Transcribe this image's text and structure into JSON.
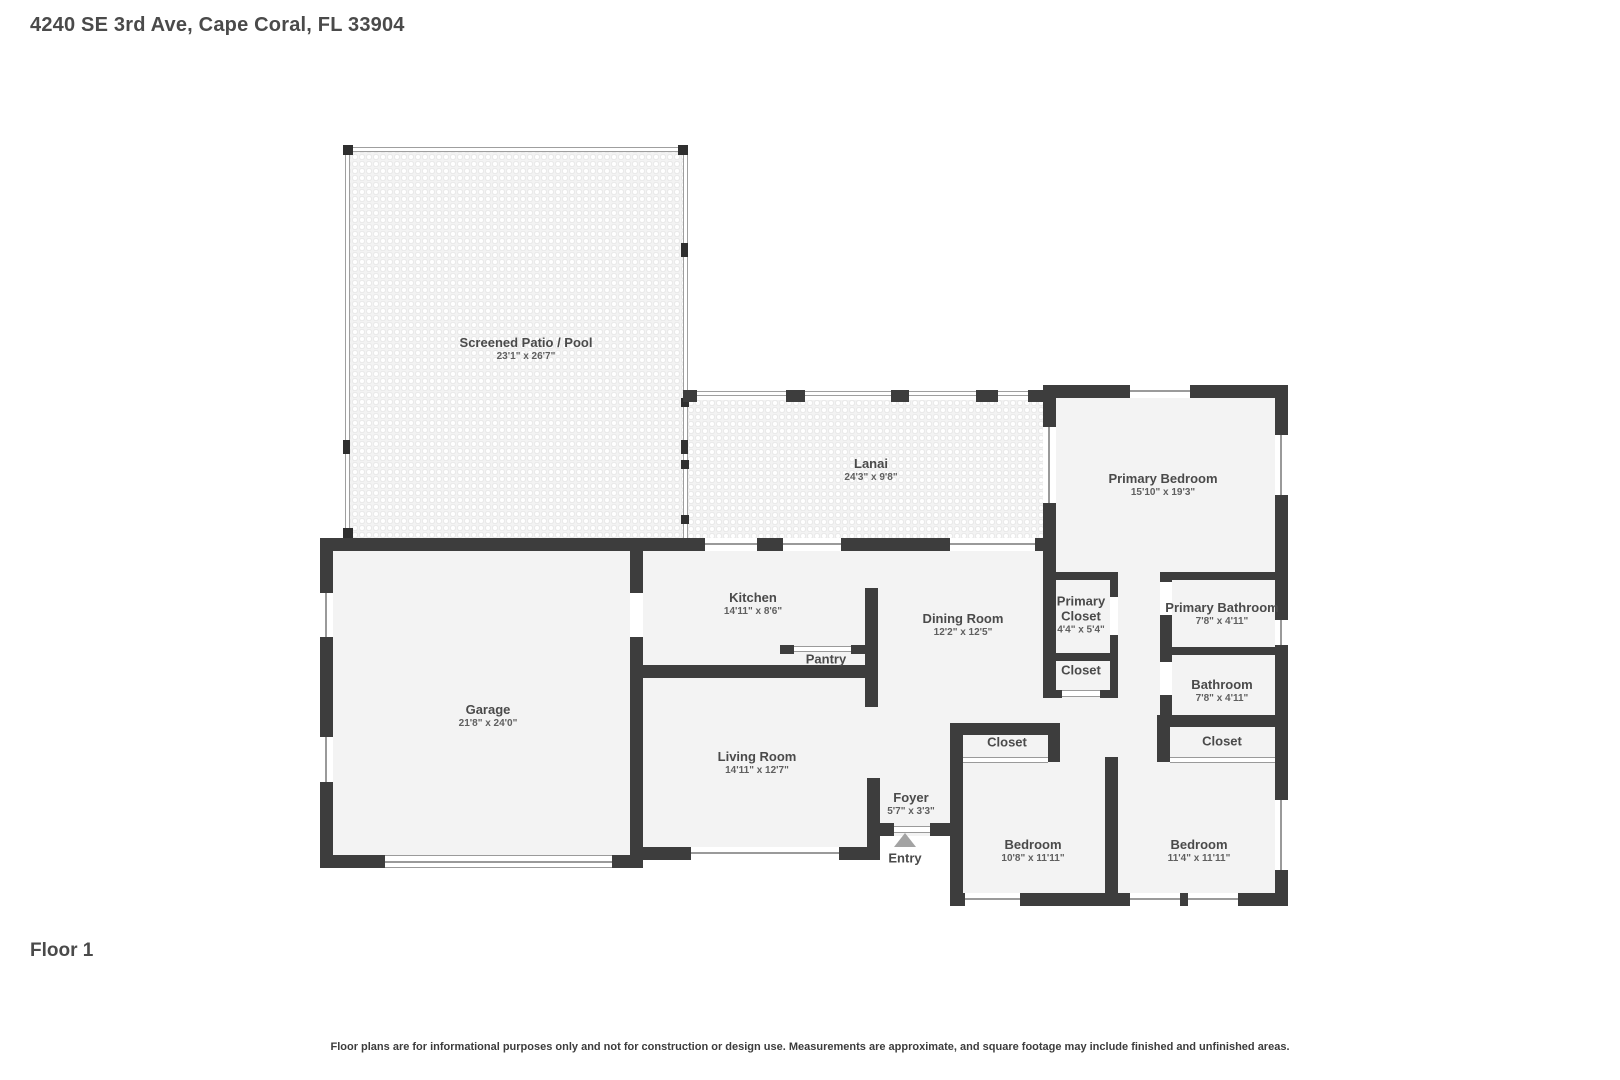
{
  "title": "4240 SE 3rd Ave, Cape Coral, FL 33904",
  "floor_label": "Floor 1",
  "disclaimer": "Floor plans are for informational purposes only and not for construction or design use. Measurements are approximate, and square footage may include finished and unfinished areas.",
  "rooms": {
    "screened_patio": {
      "label": "Screened Patio / Pool",
      "dims": "23'1\" x 26'7\""
    },
    "lanai": {
      "label": "Lanai",
      "dims": "24'3\" x 9'8\""
    },
    "primary_bedroom": {
      "label": "Primary Bedroom",
      "dims": "15'10\" x 19'3\""
    },
    "primary_closet": {
      "label": "Primary Closet",
      "dims": "4'4\" x 5'4\""
    },
    "closet_hall": {
      "label": "Closet"
    },
    "primary_bathroom": {
      "label": "Primary Bathroom",
      "dims": "7'8\" x 4'11\""
    },
    "bathroom": {
      "label": "Bathroom",
      "dims": "7'8\" x 4'11\""
    },
    "garage": {
      "label": "Garage",
      "dims": "21'8\" x 24'0\""
    },
    "kitchen": {
      "label": "Kitchen",
      "dims": "14'11\" x 8'6\""
    },
    "dining_room": {
      "label": "Dining Room",
      "dims": "12'2\" x 12'5\""
    },
    "pantry": {
      "label": "Pantry"
    },
    "living_room": {
      "label": "Living Room",
      "dims": "14'11\" x 12'7\""
    },
    "foyer": {
      "label": "Foyer",
      "dims": "5'7\" x 3'3\""
    },
    "entry": {
      "label": "Entry"
    },
    "closet_bedroom_left": {
      "label": "Closet"
    },
    "closet_bedroom_right": {
      "label": "Closet"
    },
    "bedroom_left": {
      "label": "Bedroom",
      "dims": "10'8\" x 11'11\""
    },
    "bedroom_right": {
      "label": "Bedroom",
      "dims": "11'4\" x 11'11\""
    }
  },
  "colors": {
    "wall": "#3d3d3d",
    "room_fill": "#f3f3f3",
    "text": "#4a4a4a",
    "dims_text": "#5f5f5f",
    "window_line": "#9a9a9a",
    "entry_arrow": "#a3a3a3"
  }
}
